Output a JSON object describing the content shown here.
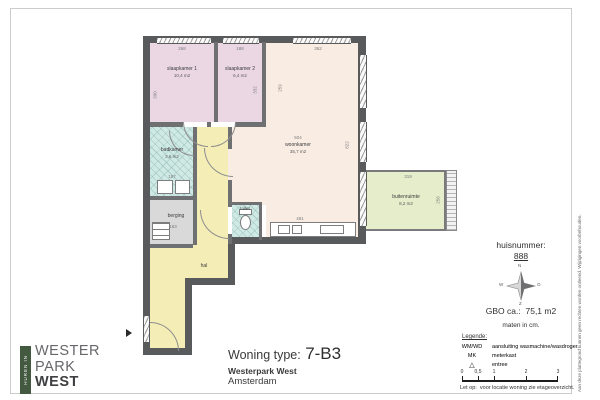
{
  "title_block": {
    "label": "Woning type:",
    "type": "7-B3",
    "project": "Westerpark West",
    "city": "Amsterdam"
  },
  "logo": {
    "vertical_text": "HUREN IN",
    "line1": "WESTER",
    "line2": "PARK",
    "line3": "WEST",
    "bar_color": "#435a41"
  },
  "info": {
    "huisnummer_label": "huisnummer:",
    "huisnummer": "888",
    "gbo_label": "GBO ca.:",
    "gbo_value": "75,1 m2",
    "units": "maten in cm.",
    "compass": {
      "n": "N",
      "e": "O",
      "s": "Z",
      "w": "W"
    },
    "legend": {
      "title": "Legende:",
      "rows": [
        {
          "key": "WM/WD",
          "value": "aansluiting wasmachine/wasdroger"
        },
        {
          "key": "MK",
          "value": "meterkast"
        },
        {
          "key": "△",
          "value": "entree"
        }
      ]
    },
    "scale_ticks": [
      "0",
      "0,5",
      "1",
      "2",
      "3"
    ],
    "note_label": "Let op:",
    "note": "voor locatie woning zie etageoverzicht."
  },
  "disclaimer": "Aan deze plattegrond kunnen geen rechten worden ontleend. Wijzigingen voorbehouden.",
  "plan": {
    "rooms": [
      {
        "name": "slaapkamer 1",
        "area": "10,4 m2"
      },
      {
        "name": "slaapkamer 2",
        "area": "6,4 m2"
      },
      {
        "name": "woonkamer",
        "area": "35,7 m2"
      },
      {
        "name": "badkamer",
        "area": "3,6 m2"
      },
      {
        "name": "berging",
        "area": ""
      },
      {
        "name": "toilet",
        "area": ""
      },
      {
        "name": "hal",
        "area": ""
      },
      {
        "name": "buitenruimte",
        "area": "8,2 m2"
      }
    ],
    "dims": [
      "268",
      "188",
      "362",
      "390",
      "332",
      "259",
      "504",
      "822",
      "157",
      "183",
      "481",
      "319",
      "256"
    ],
    "colors": {
      "bedroom": "#ead7e3",
      "living": "#f9ece3",
      "hall": "#f4edb6",
      "wet": "#cfe9e5",
      "storage": "#d9d9d9",
      "outdoor": "#e5edca",
      "wall": "#595a5c"
    }
  }
}
